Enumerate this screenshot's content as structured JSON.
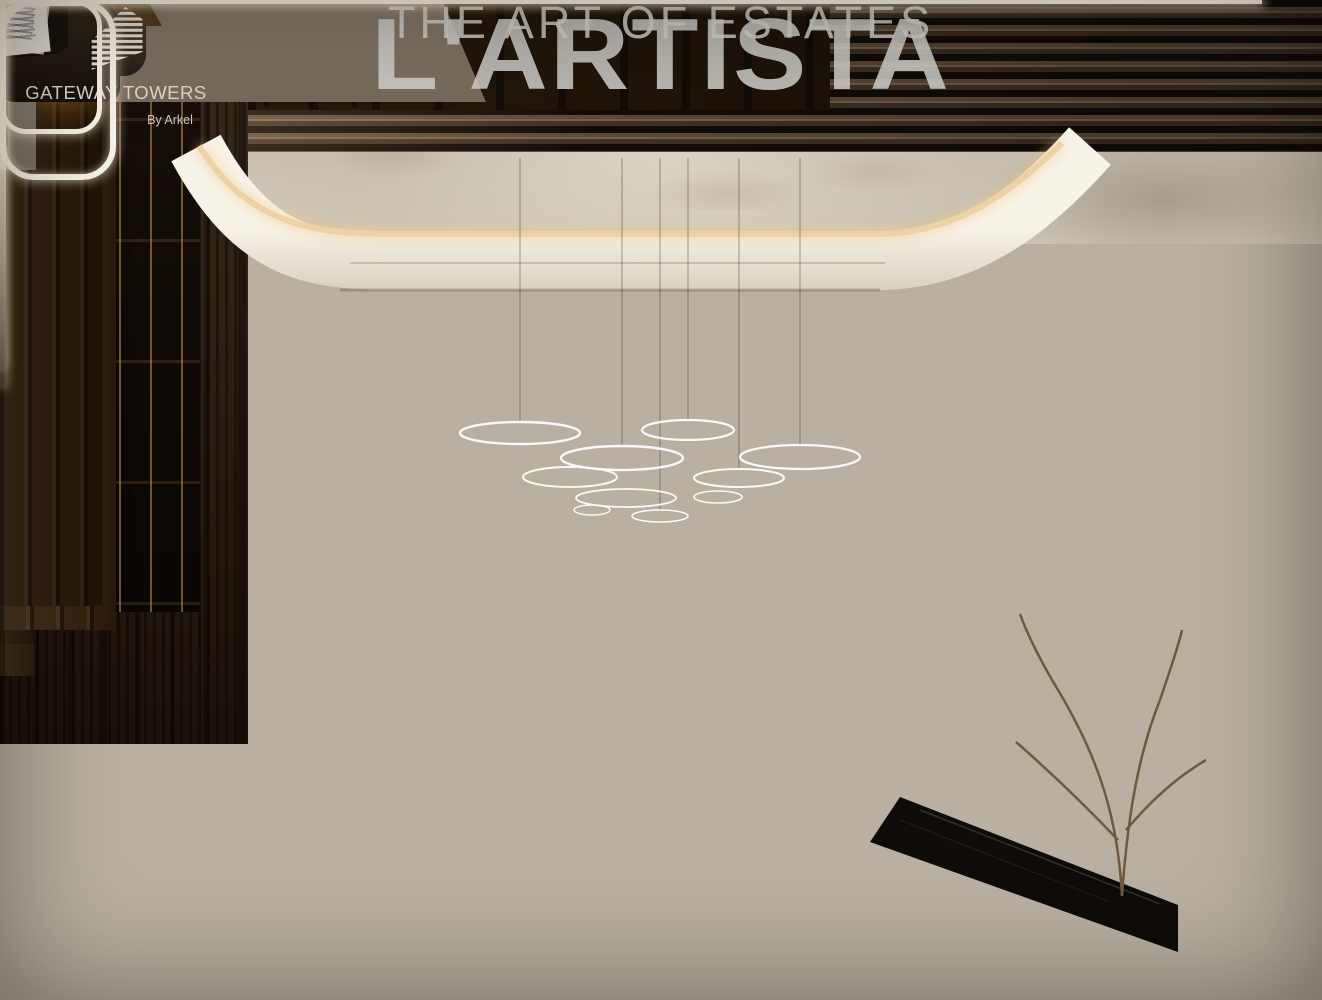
{
  "watermark": {
    "title": "L'ARTISTA",
    "tagline": "THE ART OF ESTATES"
  },
  "logo": {
    "title": "GATEWAY TOWERS",
    "byline": "By Arkel",
    "icon": "striped-towers-icon"
  },
  "colors": {
    "watermark": "#d4d2cd",
    "gold": "#e6cb9e",
    "goldDeep": "#b98e55",
    "ribbon": "#efe9dd",
    "woodDark": "#221710",
    "woodMid": "#45321f",
    "marbleGray": "#8f867a",
    "marbleLight": "#c8bfb1",
    "marbleBlack": "#100d0b",
    "floor": "#c3b9ab",
    "fire": "#ff9d38",
    "leaf": "#5f7349",
    "denim": "#7595b7",
    "leather": "#362e24",
    "teal": "#578478"
  }
}
